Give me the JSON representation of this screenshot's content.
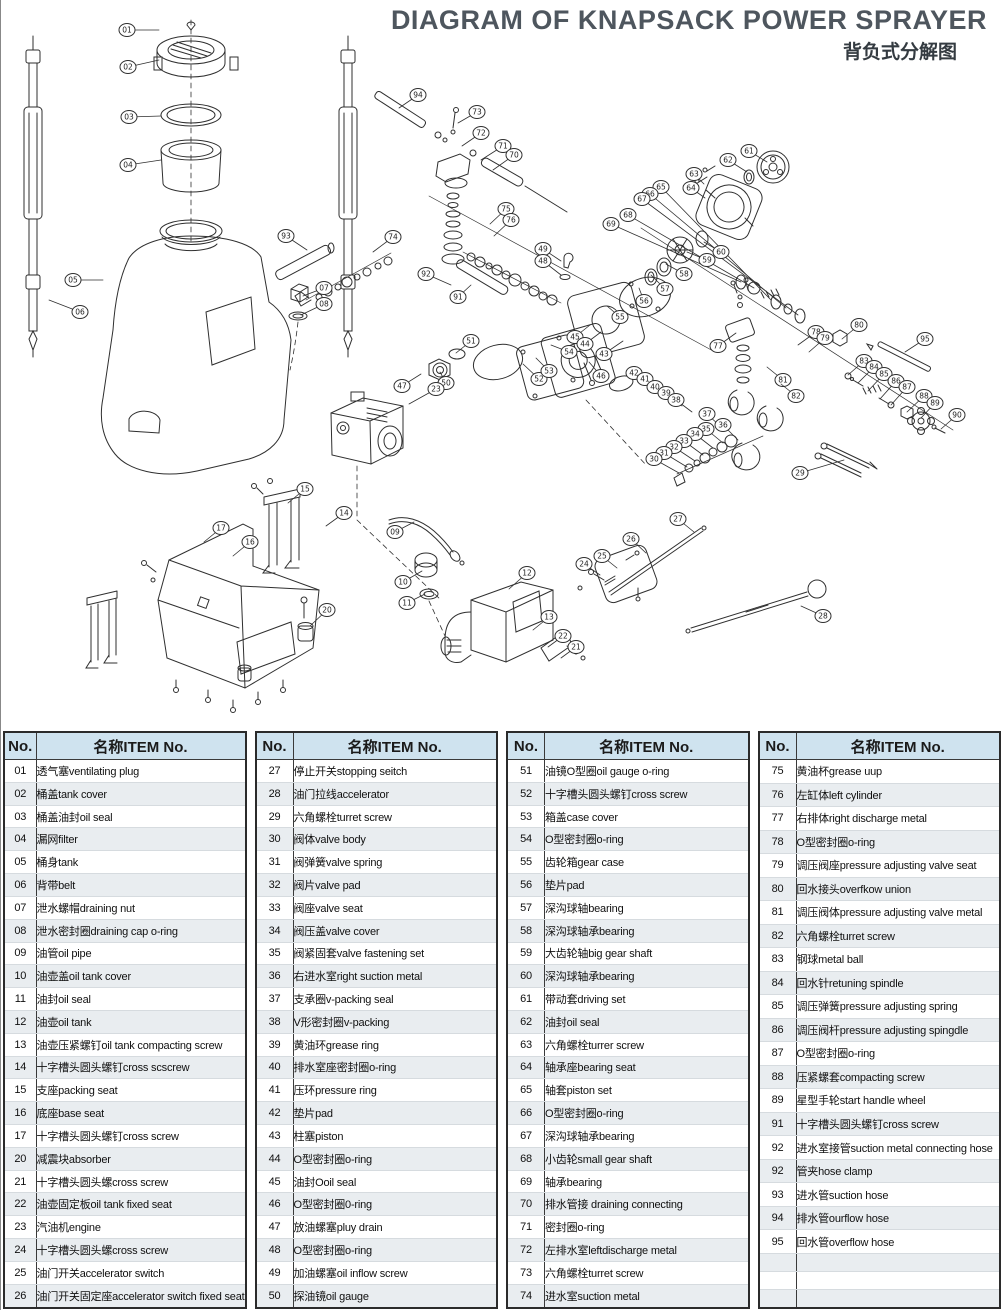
{
  "header": {
    "title": "DIAGRAM OF KNAPSACK POWER SPRAYER",
    "subtitle": "背负式分解图"
  },
  "colors": {
    "header_bg": "#cfe3ef",
    "row_alt": "#e9edf0",
    "border": "#2b2b2b",
    "line": "#2f2f2f",
    "title": "#4e565e"
  },
  "table": {
    "no_header": "No.",
    "item_header": "名称ITEM No.",
    "groups": [
      [
        {
          "no": "01",
          "item": "透气塞ventilating plug"
        },
        {
          "no": "02",
          "item": "桶盖tank cover"
        },
        {
          "no": "03",
          "item": "桶盖油封oil seal"
        },
        {
          "no": "04",
          "item": "漏网filter"
        },
        {
          "no": "05",
          "item": "桶身tank"
        },
        {
          "no": "06",
          "item": "背带belt"
        },
        {
          "no": "07",
          "item": "泄水螺帽draining nut"
        },
        {
          "no": "08",
          "item": "泄水密封圈draining cap o-ring"
        },
        {
          "no": "09",
          "item": "油管oil pipe"
        },
        {
          "no": "10",
          "item": "油壶盖oil tank cover"
        },
        {
          "no": "11",
          "item": "油封oil seal"
        },
        {
          "no": "12",
          "item": "油壶oil tank"
        },
        {
          "no": "13",
          "item": "油壶压紧螺钉oil tank compacting screw"
        },
        {
          "no": "14",
          "item": "十字槽头圆头螺钉cross scscrew"
        },
        {
          "no": "15",
          "item": "支座packing seat"
        },
        {
          "no": "16",
          "item": "底座base seat"
        },
        {
          "no": "17",
          "item": "十字槽头圆头螺钉cross screw"
        },
        {
          "no": "20",
          "item": "减震块absorber"
        },
        {
          "no": "21",
          "item": "十字槽头圆头螺cross screw"
        },
        {
          "no": "22",
          "item": "油壶固定板oil tank fixed seat"
        },
        {
          "no": "23",
          "item": "汽油机engine"
        },
        {
          "no": "24",
          "item": "十字槽头圆头螺cross screw"
        },
        {
          "no": "25",
          "item": "油门开关accelerator switch"
        },
        {
          "no": "26",
          "item": "油门开关固定座accelerator switch fixed seat"
        }
      ],
      [
        {
          "no": "27",
          "item": "停止开关stopping seitch"
        },
        {
          "no": "28",
          "item": "油门拉线accelerator"
        },
        {
          "no": "29",
          "item": "六角螺栓turret screw"
        },
        {
          "no": "30",
          "item": "阀体valve body"
        },
        {
          "no": "31",
          "item": "阀弹簧valve spring"
        },
        {
          "no": "32",
          "item": "阀片valve pad"
        },
        {
          "no": "33",
          "item": "阀座valve seat"
        },
        {
          "no": "34",
          "item": "阀压盖valve cover"
        },
        {
          "no": "35",
          "item": "阀紧固套valve fastening set"
        },
        {
          "no": "36",
          "item": "右进水室right suction metal"
        },
        {
          "no": "37",
          "item": "支承圈v-packing seal"
        },
        {
          "no": "38",
          "item": "V形密封圈v-packing"
        },
        {
          "no": "39",
          "item": "黄油环grease ring"
        },
        {
          "no": "40",
          "item": "排水室座密封圈o-ring"
        },
        {
          "no": "41",
          "item": "压环pressure ring"
        },
        {
          "no": "42",
          "item": "垫片pad"
        },
        {
          "no": "43",
          "item": "柱塞piston"
        },
        {
          "no": "44",
          "item": "O型密封圈o-ring"
        },
        {
          "no": "45",
          "item": "油封Ooil seal"
        },
        {
          "no": "46",
          "item": "O型密封圈0-ring"
        },
        {
          "no": "47",
          "item": "放油螺塞pluy drain"
        },
        {
          "no": "48",
          "item": "O型密封圈o-ring"
        },
        {
          "no": "49",
          "item": "加油螺塞oil inflow screw"
        },
        {
          "no": "50",
          "item": "探油镜oil gauge"
        }
      ],
      [
        {
          "no": "51",
          "item": "油镜O型圈oil gauge o-ring"
        },
        {
          "no": "52",
          "item": "十字槽头圆头螺钉cross screw"
        },
        {
          "no": "53",
          "item": "箱盖case cover"
        },
        {
          "no": "54",
          "item": "O型密封圈o-ring"
        },
        {
          "no": "55",
          "item": "齿轮箱gear case"
        },
        {
          "no": "56",
          "item": "垫片pad"
        },
        {
          "no": "57",
          "item": "深沟球轴bearing"
        },
        {
          "no": "58",
          "item": "深沟球轴承bearing"
        },
        {
          "no": "59",
          "item": "大齿轮轴big gear shaft"
        },
        {
          "no": "60",
          "item": "深沟球轴承bearing"
        },
        {
          "no": "61",
          "item": "带动套driving set"
        },
        {
          "no": "62",
          "item": "油封oil seal"
        },
        {
          "no": "63",
          "item": "六角螺栓turrer screw"
        },
        {
          "no": "64",
          "item": "轴承座bearing seat"
        },
        {
          "no": "65",
          "item": "轴套piston set"
        },
        {
          "no": "66",
          "item": "O型密封圈o-ring"
        },
        {
          "no": "67",
          "item": "深沟球轴承bearing"
        },
        {
          "no": "68",
          "item": "小齿轮small gear shaft"
        },
        {
          "no": "69",
          "item": "轴承bearing"
        },
        {
          "no": "70",
          "item": "排水管接 draining connecting"
        },
        {
          "no": "71",
          "item": "密封圈o-ring"
        },
        {
          "no": "72",
          "item": "左排水室leftdischarge metal"
        },
        {
          "no": "73",
          "item": "六角螺栓turret screw"
        },
        {
          "no": "74",
          "item": "进水室suction metal"
        }
      ],
      [
        {
          "no": "75",
          "item": "黄油杯grease uup"
        },
        {
          "no": "76",
          "item": "左缸体left cylinder"
        },
        {
          "no": "77",
          "item": "右排体right  discharge metal"
        },
        {
          "no": "78",
          "item": "O型密封圈o-ring"
        },
        {
          "no": "79",
          "item": "调压阀座pressure adjusting valve seat"
        },
        {
          "no": "80",
          "item": "回水接头overfkow union"
        },
        {
          "no": "81",
          "item": "调压阀体pressure adjusting valve metal"
        },
        {
          "no": "82",
          "item": "六角螺栓turret screw"
        },
        {
          "no": "83",
          "item": "钢球metal ball"
        },
        {
          "no": "84",
          "item": "回水针retuning spindle"
        },
        {
          "no": "85",
          "item": "调压弹簧pressure adjusting spring"
        },
        {
          "no": "86",
          "item": "调压阀杆pressure adjusting spingdle"
        },
        {
          "no": "87",
          "item": "O型密封圈o-ring"
        },
        {
          "no": "88",
          "item": "压紧螺套compacting screw"
        },
        {
          "no": "89",
          "item": "星型手轮start handle wheel"
        },
        {
          "no": "91",
          "item": "十字槽头圆头螺钉cross screw"
        },
        {
          "no": "92",
          "item": "进水室接管suction metal connecting hose"
        },
        {
          "no": "92",
          "item": "管夹hose clamp"
        },
        {
          "no": "93",
          "item": "进水管suction hose"
        },
        {
          "no": "94",
          "item": "排水管ourflow hose"
        },
        {
          "no": "95",
          "item": "回水管overflow hose"
        },
        {
          "no": "",
          "item": ""
        },
        {
          "no": "",
          "item": ""
        },
        {
          "no": "",
          "item": ""
        }
      ]
    ]
  },
  "diagram": {
    "callouts": [
      {
        "n": "01",
        "x": 126,
        "y": 30,
        "tx": 158,
        "ty": 30
      },
      {
        "n": "02",
        "x": 127,
        "y": 67,
        "tx": 158,
        "ty": 60
      },
      {
        "n": "03",
        "x": 128,
        "y": 117,
        "tx": 160,
        "ty": 116
      },
      {
        "n": "04",
        "x": 127,
        "y": 165,
        "tx": 160,
        "ty": 160
      },
      {
        "n": "05",
        "x": 72,
        "y": 280,
        "tx": 102,
        "ty": 280
      },
      {
        "n": "06",
        "x": 79,
        "y": 312,
        "tx": 48,
        "ty": 300
      },
      {
        "n": "07",
        "x": 323,
        "y": 288,
        "tx": 302,
        "ty": 296
      },
      {
        "n": "08",
        "x": 323,
        "y": 304,
        "tx": 300,
        "ty": 315
      },
      {
        "n": "93",
        "x": 285,
        "y": 236,
        "tx": 306,
        "ty": 250
      },
      {
        "n": "94",
        "x": 417,
        "y": 95,
        "tx": 398,
        "ty": 108
      },
      {
        "n": "73",
        "x": 476,
        "y": 112,
        "tx": 457,
        "ty": 123
      },
      {
        "n": "72",
        "x": 480,
        "y": 133,
        "tx": 461,
        "ty": 146
      },
      {
        "n": "71",
        "x": 502,
        "y": 146,
        "tx": 480,
        "ty": 160
      },
      {
        "n": "70",
        "x": 513,
        "y": 155,
        "tx": 492,
        "ty": 170
      },
      {
        "n": "63",
        "x": 693,
        "y": 174,
        "tx": 703,
        "ty": 184
      },
      {
        "n": "64",
        "x": 690,
        "y": 188,
        "tx": 704,
        "ty": 198
      },
      {
        "n": "65",
        "x": 660,
        "y": 187,
        "tx": 770,
        "ty": 300
      },
      {
        "n": "66",
        "x": 649,
        "y": 194,
        "tx": 785,
        "ty": 308
      },
      {
        "n": "67",
        "x": 641,
        "y": 199,
        "tx": 797,
        "ty": 315
      },
      {
        "n": "68",
        "x": 627,
        "y": 215,
        "tx": 753,
        "ty": 288
      },
      {
        "n": "69",
        "x": 610,
        "y": 224,
        "tx": 740,
        "ty": 282
      },
      {
        "n": "75",
        "x": 505,
        "y": 209,
        "tx": 489,
        "ty": 224
      },
      {
        "n": "76",
        "x": 510,
        "y": 220,
        "tx": 493,
        "ty": 236
      },
      {
        "n": "74",
        "x": 392,
        "y": 237,
        "tx": 372,
        "ty": 252
      },
      {
        "n": "92",
        "x": 425,
        "y": 274,
        "tx": 450,
        "ty": 285
      },
      {
        "n": "91",
        "x": 457,
        "y": 297,
        "tx": 470,
        "ty": 285
      },
      {
        "n": "49",
        "x": 542,
        "y": 249,
        "tx": 560,
        "ty": 261
      },
      {
        "n": "48",
        "x": 542,
        "y": 261,
        "tx": 560,
        "ty": 275
      },
      {
        "n": "59",
        "x": 706,
        "y": 260,
        "tx": 686,
        "ty": 252
      },
      {
        "n": "58",
        "x": 683,
        "y": 274,
        "tx": 665,
        "ty": 264
      },
      {
        "n": "57",
        "x": 664,
        "y": 289,
        "tx": 650,
        "ty": 275
      },
      {
        "n": "56",
        "x": 643,
        "y": 301,
        "tx": 638,
        "ty": 288
      },
      {
        "n": "55",
        "x": 619,
        "y": 317,
        "tx": 606,
        "ty": 306
      },
      {
        "n": "45",
        "x": 574,
        "y": 337,
        "tx": 589,
        "ty": 325
      },
      {
        "n": "44",
        "x": 584,
        "y": 344,
        "tx": 600,
        "ty": 332
      },
      {
        "n": "43",
        "x": 603,
        "y": 354,
        "tx": 622,
        "ty": 341
      },
      {
        "n": "54",
        "x": 568,
        "y": 352,
        "tx": 550,
        "ty": 345
      },
      {
        "n": "51",
        "x": 470,
        "y": 341,
        "tx": 455,
        "ty": 353
      },
      {
        "n": "50",
        "x": 445,
        "y": 383,
        "tx": 439,
        "ty": 372
      },
      {
        "n": "52",
        "x": 538,
        "y": 379,
        "tx": 522,
        "ty": 364
      },
      {
        "n": "53",
        "x": 548,
        "y": 371,
        "tx": 535,
        "ty": 358
      },
      {
        "n": "46",
        "x": 600,
        "y": 376,
        "tx": 588,
        "ty": 362
      },
      {
        "n": "47",
        "x": 401,
        "y": 386,
        "tx": 420,
        "ty": 374
      },
      {
        "n": "61",
        "x": 748,
        "y": 151,
        "tx": 766,
        "ty": 162
      },
      {
        "n": "62",
        "x": 727,
        "y": 160,
        "tx": 746,
        "ty": 172
      },
      {
        "n": "60",
        "x": 720,
        "y": 252,
        "tx": 703,
        "ty": 242
      },
      {
        "n": "77",
        "x": 717,
        "y": 346,
        "tx": 735,
        "ty": 333
      },
      {
        "n": "78",
        "x": 815,
        "y": 332,
        "tx": 797,
        "ty": 345
      },
      {
        "n": "79",
        "x": 824,
        "y": 338,
        "tx": 808,
        "ty": 352
      },
      {
        "n": "80",
        "x": 858,
        "y": 325,
        "tx": 841,
        "ty": 339
      },
      {
        "n": "81",
        "x": 782,
        "y": 380,
        "tx": 766,
        "ty": 367
      },
      {
        "n": "82",
        "x": 795,
        "y": 396,
        "tx": 780,
        "ty": 384
      },
      {
        "n": "83",
        "x": 863,
        "y": 361,
        "tx": 847,
        "ty": 375
      },
      {
        "n": "84",
        "x": 873,
        "y": 367,
        "tx": 857,
        "ty": 383
      },
      {
        "n": "85",
        "x": 883,
        "y": 374,
        "tx": 867,
        "ty": 391
      },
      {
        "n": "86",
        "x": 895,
        "y": 381,
        "tx": 879,
        "ty": 399
      },
      {
        "n": "87",
        "x": 906,
        "y": 387,
        "tx": 890,
        "ty": 405
      },
      {
        "n": "88",
        "x": 923,
        "y": 396,
        "tx": 906,
        "ty": 412
      },
      {
        "n": "89",
        "x": 934,
        "y": 403,
        "tx": 920,
        "ty": 418
      },
      {
        "n": "90",
        "x": 956,
        "y": 415,
        "tx": 940,
        "ty": 429
      },
      {
        "n": "95",
        "x": 924,
        "y": 339,
        "tx": 904,
        "ty": 352
      },
      {
        "n": "42",
        "x": 633,
        "y": 373,
        "tx": 649,
        "ty": 388
      },
      {
        "n": "41",
        "x": 644,
        "y": 379,
        "tx": 661,
        "ty": 394
      },
      {
        "n": "40",
        "x": 654,
        "y": 387,
        "tx": 671,
        "ty": 400
      },
      {
        "n": "39",
        "x": 665,
        "y": 393,
        "tx": 681,
        "ty": 406
      },
      {
        "n": "38",
        "x": 675,
        "y": 400,
        "tx": 691,
        "ty": 412
      },
      {
        "n": "37",
        "x": 706,
        "y": 414,
        "tx": 719,
        "ty": 426
      },
      {
        "n": "36",
        "x": 722,
        "y": 425,
        "tx": 737,
        "ty": 440
      },
      {
        "n": "35",
        "x": 705,
        "y": 429,
        "tx": 722,
        "ty": 443
      },
      {
        "n": "34",
        "x": 694,
        "y": 434,
        "tx": 712,
        "ty": 448
      },
      {
        "n": "33",
        "x": 683,
        "y": 441,
        "tx": 702,
        "ty": 455
      },
      {
        "n": "32",
        "x": 673,
        "y": 447,
        "tx": 694,
        "ty": 461
      },
      {
        "n": "31",
        "x": 663,
        "y": 453,
        "tx": 686,
        "ty": 467
      },
      {
        "n": "30",
        "x": 653,
        "y": 459,
        "tx": 678,
        "ty": 473
      },
      {
        "n": "29",
        "x": 799,
        "y": 473,
        "tx": 843,
        "ty": 460
      },
      {
        "n": "15",
        "x": 304,
        "y": 489,
        "tx": 287,
        "ty": 503
      },
      {
        "n": "14",
        "x": 343,
        "y": 513,
        "tx": 325,
        "ty": 526
      },
      {
        "n": "17",
        "x": 220,
        "y": 528,
        "tx": 203,
        "ty": 542
      },
      {
        "n": "16",
        "x": 249,
        "y": 542,
        "tx": 232,
        "ty": 556
      },
      {
        "n": "20",
        "x": 326,
        "y": 610,
        "tx": 309,
        "ty": 626
      },
      {
        "n": "23",
        "x": 435,
        "y": 389,
        "tx": 408,
        "ty": 404
      },
      {
        "n": "09",
        "x": 394,
        "y": 532,
        "tx": 413,
        "ty": 522
      },
      {
        "n": "10",
        "x": 402,
        "y": 582,
        "tx": 421,
        "ty": 571
      },
      {
        "n": "11",
        "x": 406,
        "y": 603,
        "tx": 424,
        "ty": 594
      },
      {
        "n": "12",
        "x": 526,
        "y": 573,
        "tx": 508,
        "ty": 589
      },
      {
        "n": "13",
        "x": 548,
        "y": 617,
        "tx": 532,
        "ty": 630
      },
      {
        "n": "22",
        "x": 562,
        "y": 636,
        "tx": 547,
        "ty": 647
      },
      {
        "n": "21",
        "x": 575,
        "y": 647,
        "tx": 560,
        "ty": 658
      },
      {
        "n": "24",
        "x": 583,
        "y": 564,
        "tx": 599,
        "ty": 575
      },
      {
        "n": "25",
        "x": 601,
        "y": 556,
        "tx": 616,
        "ty": 568
      },
      {
        "n": "26",
        "x": 630,
        "y": 539,
        "tx": 645,
        "ty": 553
      },
      {
        "n": "27",
        "x": 677,
        "y": 519,
        "tx": 693,
        "ty": 532
      },
      {
        "n": "28",
        "x": 822,
        "y": 616,
        "tx": 800,
        "ty": 606
      }
    ]
  }
}
